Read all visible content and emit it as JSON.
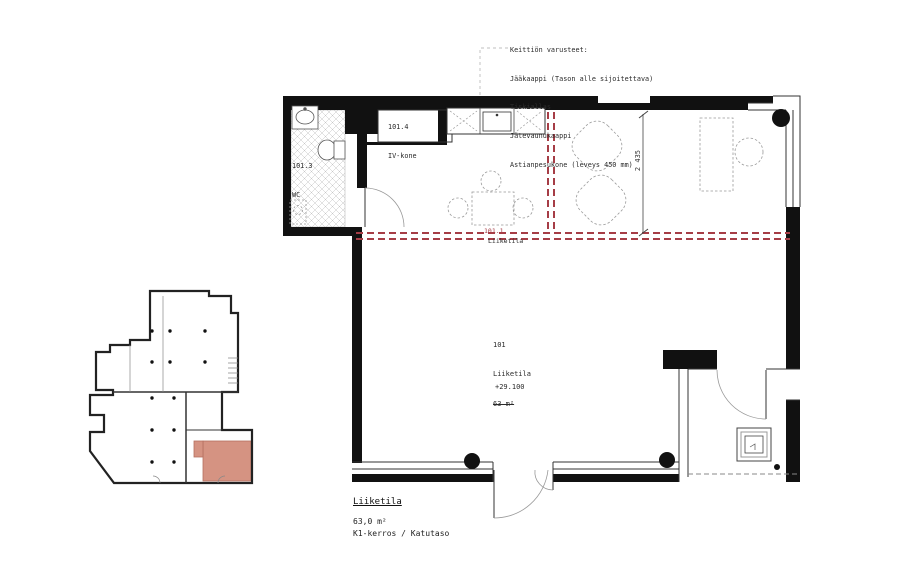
{
  "drawing": {
    "kitchen_notes": {
      "heading": "Keittiön varusteet:",
      "items": [
        "Jääkaappi (Tason alle sijoitettava)",
        "Tiskiallas",
        "Jätevaunukaappi",
        "Astianpesukone (leveys 450 mm)"
      ]
    },
    "labels": {
      "iv_room_number": "101.4",
      "iv_room_name": "IV-kone",
      "wc_number": "101.3",
      "wc_name": "WC",
      "zone_number": "101.1",
      "zone_name": "Liiketila",
      "main_number": "101",
      "main_name": "Liiketila",
      "main_area": "63 m²",
      "level_mark": "+29.100",
      "dim_lounge": "2 435"
    },
    "title_block": {
      "name": "Liiketila",
      "area": "63,0 m²",
      "floor": "K1-kerros / Katutaso"
    },
    "colors": {
      "wall": "#111111",
      "zone_boundary": "#a63d46",
      "key_plan_highlight": "#d59382"
    }
  }
}
